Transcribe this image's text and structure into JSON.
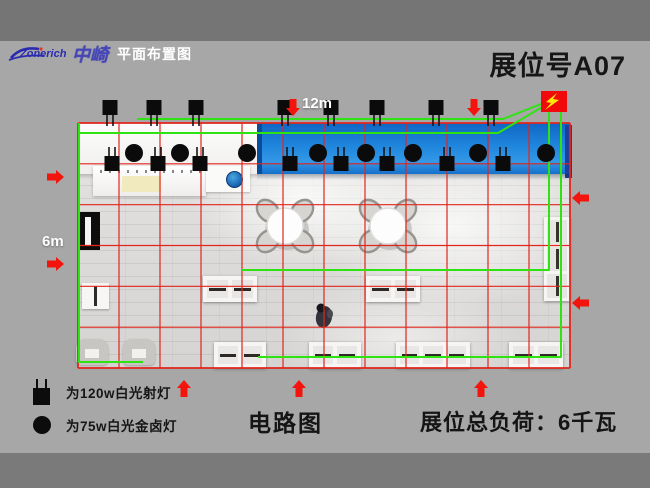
{
  "header": {
    "logo_text": "Zonerich",
    "logo_cn": "中崎",
    "subtitle": "平面布置图",
    "booth_no": "展位号A07"
  },
  "dimensions": {
    "width_label": "12m",
    "height_label": "6m"
  },
  "legend": {
    "items": [
      {
        "symbol": "spotlight-square-icon",
        "label": "为120w白光射灯"
      },
      {
        "symbol": "halide-circle-icon",
        "label": "为75w白光金卤灯"
      }
    ]
  },
  "footer": {
    "circuit_label": "电路图",
    "load_label": "展位总负荷：6千瓦"
  },
  "colors": {
    "bg_top": "#757575",
    "bg_main": "#a7a7a7",
    "bg_bottom": "#7a7a7a",
    "grid_red": "#e1261d",
    "arrow_red": "#f2140d",
    "wire_green": "#2fe312",
    "banner_blue": "#1f86dd",
    "power_red": "#f00a0a",
    "bolt_yellow": "#ffe60a",
    "lamp_black": "#0b0b0b"
  },
  "plan": {
    "x": 78,
    "y": 123,
    "w": 492,
    "h": 245,
    "cols": 12,
    "rows": 6,
    "lights": {
      "squares_top_x": [
        110,
        154,
        196,
        285,
        331,
        377,
        436,
        491
      ],
      "squares_mid_x": [
        112,
        158,
        200,
        290,
        341,
        387,
        447,
        503
      ],
      "circles_x": [
        134,
        180,
        247,
        318,
        366,
        413,
        478,
        546
      ],
      "squares_top_y": 100,
      "squares_mid_y": 156,
      "circles_y": 153
    },
    "wires": [
      [
        [
          79,
          123
        ],
        [
          79,
          362
        ],
        [
          143,
          362
        ]
      ],
      [
        [
          79,
          133
        ],
        [
          498,
          133
        ],
        [
          549,
          103
        ]
      ],
      [
        [
          137,
          119
        ],
        [
          503,
          119
        ],
        [
          551,
          100
        ]
      ],
      [
        [
          549,
          112
        ],
        [
          549,
          270
        ],
        [
          242,
          270
        ]
      ],
      [
        [
          561,
          112
        ],
        [
          561,
          357
        ],
        [
          258,
          357
        ]
      ]
    ],
    "power_box": {
      "x": 541,
      "y": 91,
      "w": 26,
      "h": 21
    },
    "arrows": [
      {
        "x": 64,
        "y": 177,
        "dir": "right"
      },
      {
        "x": 64,
        "y": 264,
        "dir": "right"
      },
      {
        "x": 293,
        "y": 116,
        "dir": "down"
      },
      {
        "x": 474,
        "y": 116,
        "dir": "down"
      },
      {
        "x": 572,
        "y": 198,
        "dir": "left"
      },
      {
        "x": 572,
        "y": 303,
        "dir": "left"
      },
      {
        "x": 184,
        "y": 380,
        "dir": "up"
      },
      {
        "x": 299,
        "y": 380,
        "dir": "up"
      },
      {
        "x": 481,
        "y": 380,
        "dir": "up"
      }
    ],
    "tables": [
      [
        285,
        226
      ],
      [
        388,
        226
      ]
    ],
    "person": [
      324,
      317
    ]
  }
}
